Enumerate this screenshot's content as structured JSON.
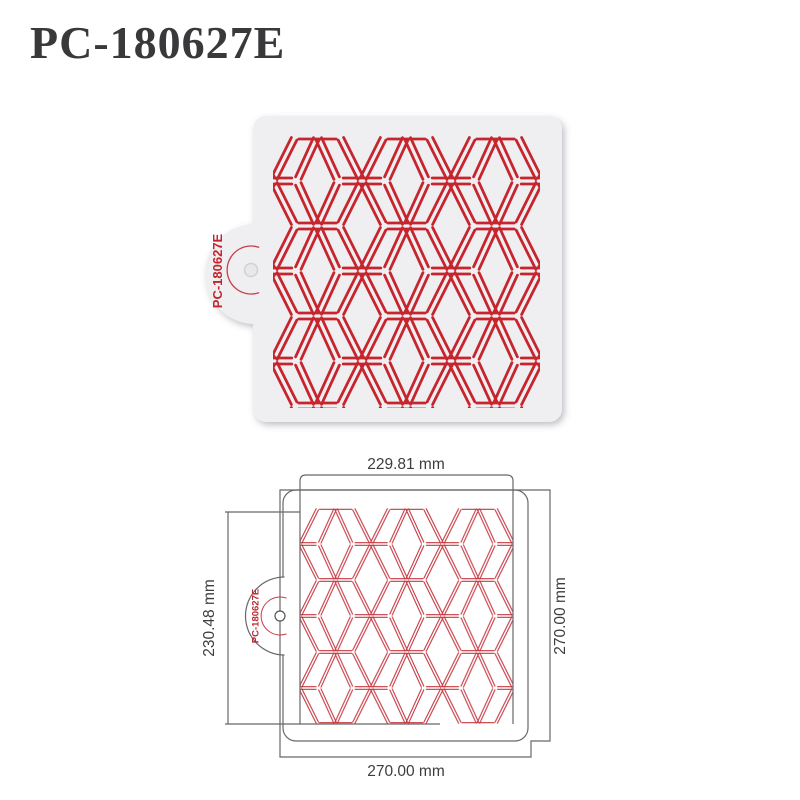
{
  "title": "PC-180627E",
  "photo": {
    "tab_code": "PC-180627E"
  },
  "drawing": {
    "tab_code": "PC-180627E",
    "dim_top": "229.81 mm",
    "dim_left": "230.48 mm",
    "dim_right": "270.00 mm",
    "dim_bottom": "270.00 mm"
  },
  "colors": {
    "pattern_red": "#c6252e",
    "drawing_pattern_red": "#c63a43",
    "accent_red": "#c2252e",
    "line_gray": "#68686c",
    "label_gray": "#3d3d3f",
    "stencil_fill": "#efeff1",
    "hole_fill": "#e8e8ea"
  }
}
